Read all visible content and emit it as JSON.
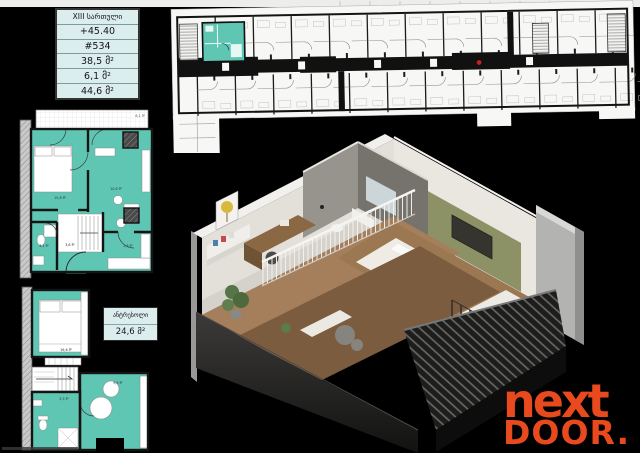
{
  "page": {
    "background": "#000000",
    "top_strip_color": "#ededeb"
  },
  "info_table": {
    "floor": "XIII სართული",
    "elevation": "+45.40",
    "unit": "#534",
    "area_living": "38,5 მ²",
    "area_balcony": "6,1 მ²",
    "area_total": "44,6 მ²"
  },
  "mezzanine_box": {
    "title": "ანტრესოლი",
    "area": "24,6 მ²"
  },
  "plan_labels": {
    "upper": {
      "terrace": "6,1 მ²",
      "bedroom": "15,6 მ²",
      "living": "10,6 მ²",
      "hall": "3,6 მ²",
      "bath": "4,1 მ²",
      "kitchen": "2,6 მ²"
    },
    "lower": {
      "bedroom": "16,6 მ²",
      "bath": "3,3 მ²",
      "room": "9,9 მ²"
    }
  },
  "logo": {
    "line1": "next",
    "line2": "DOOR.",
    "color": "#e8491d"
  },
  "colors": {
    "plan_teal": "#5fc6b3",
    "info_bg": "#dcedee",
    "accent_green_wall": "#8c9166",
    "bed_red": "#a62739",
    "wood_floor": "#a57f5b",
    "marker_red": "#c22222"
  }
}
